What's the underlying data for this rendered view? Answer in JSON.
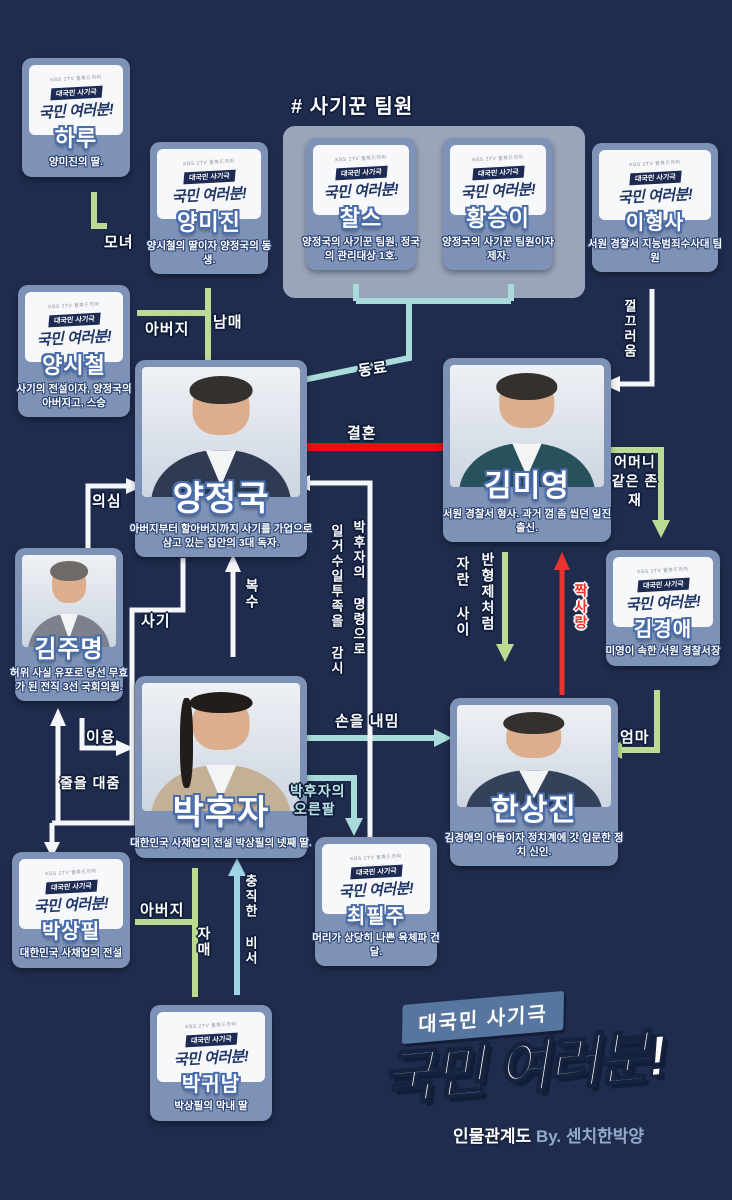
{
  "meta": {
    "background": "#1f2c4d",
    "chart_kind": "drama character relationship map"
  },
  "logo_card": {
    "broadcaster": "KBS 2TV 월화드라마",
    "badge": "대국민 사기극",
    "title": "국민 여러분!"
  },
  "group": {
    "header": "# 사기꾼 팀원"
  },
  "characters": {
    "haru": {
      "name": "하루",
      "desc": "양미진의 딸."
    },
    "yangmijin": {
      "name": "양미진",
      "desc": "양시철의 딸이자 양정국의 동생."
    },
    "charles": {
      "name": "찰스",
      "desc": "양정국의 사기꾼 팀원, 정국의 관리대상 1호."
    },
    "hwangseungyi": {
      "name": "황승이",
      "desc": "양정국의 사기꾼 팀원이자 제자."
    },
    "leehyungsa": {
      "name": "이형사",
      "desc": "서원 경찰서 지능범죄수사대 팀원"
    },
    "yangsichul": {
      "name": "양시철",
      "desc": "사기의 전설이자, 양정국의 아버지고, 스승"
    },
    "yangjungkook": {
      "name": "양정국",
      "desc": "아버지부터 할아버지까지 사기를 가업으로 삼고 있는 집안의 3대 독자."
    },
    "kimmiyoung": {
      "name": "김미영",
      "desc": "서원 경찰서 형사. 과거 껌 좀 씹던 일진 출신."
    },
    "kimjumyung": {
      "name": "김주명",
      "desc": "허위 사실 유포로 당선 무효가 된 전직 3선 국회의원."
    },
    "kimkyungae": {
      "name": "김경애",
      "desc": "미영이 속한 서원 경찰서장"
    },
    "parkhooja": {
      "name": "박후자",
      "desc": "대한민국 사채업의 전설 박상필의 넷째 딸."
    },
    "hansangjin": {
      "name": "한상진",
      "desc": "김경애의 아들이자 정치계에 갓 입문한 정치 신인."
    },
    "parksangpil": {
      "name": "박상필",
      "desc": "대한민국 사채업의 전설"
    },
    "choipilju": {
      "name": "최필주",
      "desc": "머리가 상당히 나쁜 육체파 건달."
    },
    "parkgwinam": {
      "name": "박귀남",
      "desc": "박상필의 막내 딸"
    }
  },
  "relations": {
    "monyeo": "모녀",
    "abeoji_yang": "아버지",
    "nammae": "남매",
    "dongryo": "동료",
    "kkeulkkeureoum": "껄끄러움",
    "gyeolhon": "결혼",
    "uisim": "의심",
    "sagi": "사기",
    "eomeoni_gateun": "어머니 같은 존재",
    "jjaksarang": "짝사랑",
    "ban_hyungje": "반형제처럼",
    "jaran_sai": "자란 사이",
    "eomma": "엄마",
    "boksu": "복수",
    "iyong": "이용",
    "jureul_daejum": "줄을 대줌",
    "soneul_naemim": "손을 내밈",
    "oreunpal_line1": "박후자의",
    "oreunpal_line2": "오른팔",
    "gamsi_col_right": "박후자의 명령으로",
    "gamsi_col_left": "일거수일투족을 감시",
    "chungjik_biseo": "충직한 비서",
    "abeoji_park": "아버지",
    "jamae": "자매"
  },
  "footer": {
    "badge": "대국민 사기극",
    "title": "국민 여러분!",
    "credit_prefix": "인물관계도",
    "credit_by": "By. 센치한박양"
  },
  "colors": {
    "line_green": "#b9dc92",
    "line_teal": "#a8dbd9",
    "line_light_blue": "#9fd4e5",
    "line_red": "#e50f14",
    "line_white": "#f4f6f9",
    "card_blue": "#7e92b7",
    "group_gray": "#9aa5ba"
  }
}
